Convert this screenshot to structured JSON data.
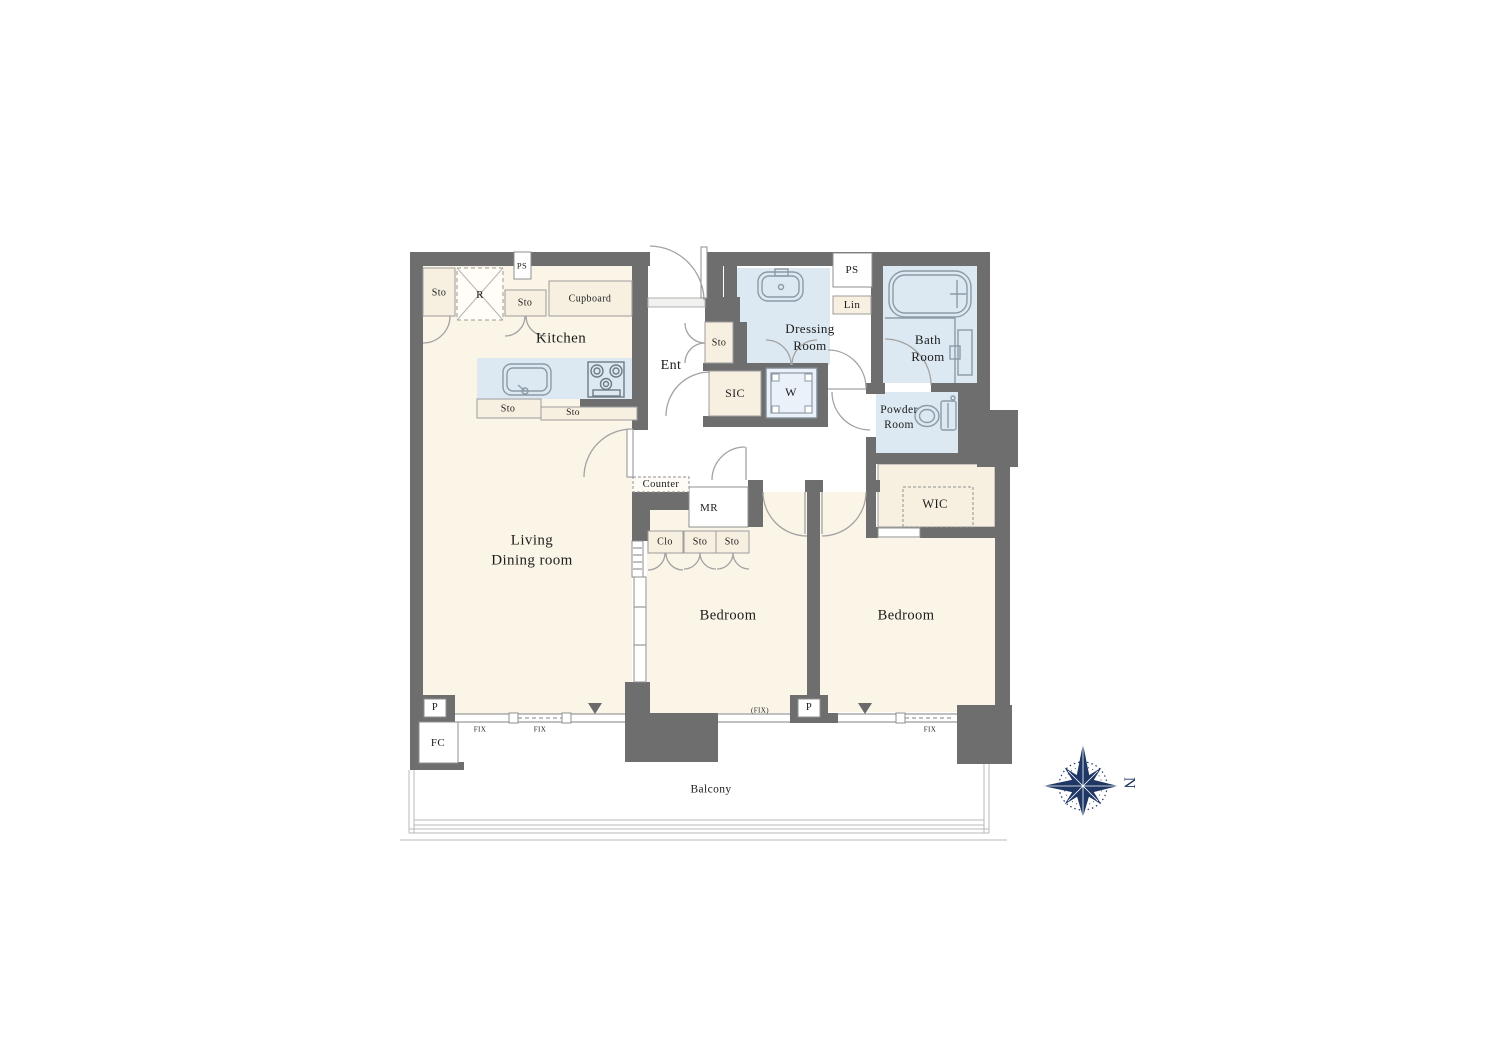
{
  "palette": {
    "wall": "#6e6e6e",
    "floor_cream": "#faf5e7",
    "wet_blue": "#dde9f2",
    "storage_beige": "#f7f0e1",
    "compass_navy": "#1f3765",
    "ink": "#1c1c1c"
  },
  "icons": [
    "refrigerator-icon",
    "kitchen-sink-icon",
    "stove-icon",
    "washbasin-icon",
    "bathtub-icon",
    "toilet-icon",
    "washing-machine-icon",
    "compass-rose-icon",
    "entry-arrow-marker"
  ],
  "labels": [
    {
      "n": "kitchen-label",
      "t": "Kitchen",
      "x": 561,
      "y": 339,
      "s": 15
    },
    {
      "n": "living-dining-label",
      "t": "Living\nDining room",
      "x": 532,
      "y": 551,
      "s": 15
    },
    {
      "n": "entrance-label",
      "t": "Ent",
      "x": 671,
      "y": 366,
      "s": 14
    },
    {
      "n": "dressing-room-label",
      "t": "Dressing\nRoom",
      "x": 810,
      "y": 338,
      "s": 13
    },
    {
      "n": "bath-room-label",
      "t": "Bath\nRoom",
      "x": 928,
      "y": 349,
      "s": 13
    },
    {
      "n": "powder-room-label",
      "t": "Powder\nRoom",
      "x": 899,
      "y": 418,
      "s": 11.5
    },
    {
      "n": "wic-label",
      "t": "WIC",
      "x": 935,
      "y": 504,
      "s": 12.5
    },
    {
      "n": "bedroom-1-label",
      "t": "Bedroom",
      "x": 728,
      "y": 616,
      "s": 14.5
    },
    {
      "n": "bedroom-2-label",
      "t": "Bedroom",
      "x": 906,
      "y": 616,
      "s": 14.5
    },
    {
      "n": "balcony-label",
      "t": "Balcony",
      "x": 711,
      "y": 790,
      "s": 11.5
    },
    {
      "n": "storage-topleft-label",
      "t": "Sto",
      "x": 439,
      "y": 293,
      "s": 10
    },
    {
      "n": "refrigerator-label",
      "t": "R",
      "x": 480,
      "y": 295,
      "s": 11
    },
    {
      "n": "storage-kitchen-label",
      "t": "Sto",
      "x": 525,
      "y": 303,
      "s": 10
    },
    {
      "n": "cupboard-label",
      "t": "Cupboard",
      "x": 590,
      "y": 299,
      "s": 10
    },
    {
      "n": "storage-counter-left-label",
      "t": "Sto",
      "x": 508,
      "y": 409,
      "s": 10
    },
    {
      "n": "storage-counter-right-label",
      "t": "Sto",
      "x": 573,
      "y": 413,
      "s": 9.5
    },
    {
      "n": "pipe-space-left-label",
      "t": "PS",
      "x": 522,
      "y": 266,
      "s": 8.5
    },
    {
      "n": "pipe-space-right-label",
      "t": "PS",
      "x": 852,
      "y": 270,
      "s": 11
    },
    {
      "n": "linen-label",
      "t": "Lin",
      "x": 852,
      "y": 305,
      "s": 11
    },
    {
      "n": "storage-entrance-label",
      "t": "Sto",
      "x": 719,
      "y": 343,
      "s": 10
    },
    {
      "n": "sic-label",
      "t": "SIC",
      "x": 735,
      "y": 394,
      "s": 12
    },
    {
      "n": "washer-label",
      "t": "W",
      "x": 791,
      "y": 393,
      "s": 12
    },
    {
      "n": "counter-label",
      "t": "Counter",
      "x": 661,
      "y": 485,
      "s": 10.5
    },
    {
      "n": "meter-room-label",
      "t": "MR",
      "x": 709,
      "y": 508,
      "s": 11
    },
    {
      "n": "closet-label",
      "t": "Clo",
      "x": 665,
      "y": 542,
      "s": 10
    },
    {
      "n": "storage-a-label",
      "t": "Sto",
      "x": 700,
      "y": 542,
      "s": 10
    },
    {
      "n": "storage-b-label",
      "t": "Sto",
      "x": 732,
      "y": 542,
      "s": 10
    },
    {
      "n": "pipe-left-label",
      "t": "P",
      "x": 435,
      "y": 708,
      "s": 10.5
    },
    {
      "n": "fc-label",
      "t": "FC",
      "x": 438,
      "y": 743,
      "s": 11
    },
    {
      "n": "pipe-right-label",
      "t": "P",
      "x": 809,
      "y": 708,
      "s": 10.5
    },
    {
      "n": "fix-window-1-label",
      "t": "FIX",
      "x": 480,
      "y": 730,
      "s": 7
    },
    {
      "n": "fix-window-2-label",
      "t": "FIX",
      "x": 540,
      "y": 730,
      "s": 7
    },
    {
      "n": "fix-window-3-label",
      "t": "(FIX)",
      "x": 760,
      "y": 711,
      "s": 7
    },
    {
      "n": "fix-window-4-label",
      "t": "FIX",
      "x": 930,
      "y": 730,
      "s": 7
    },
    {
      "n": "north-label",
      "t": "N",
      "x": 1128,
      "y": 783,
      "s": 16,
      "r": 90,
      "c": "#1f3765"
    }
  ]
}
